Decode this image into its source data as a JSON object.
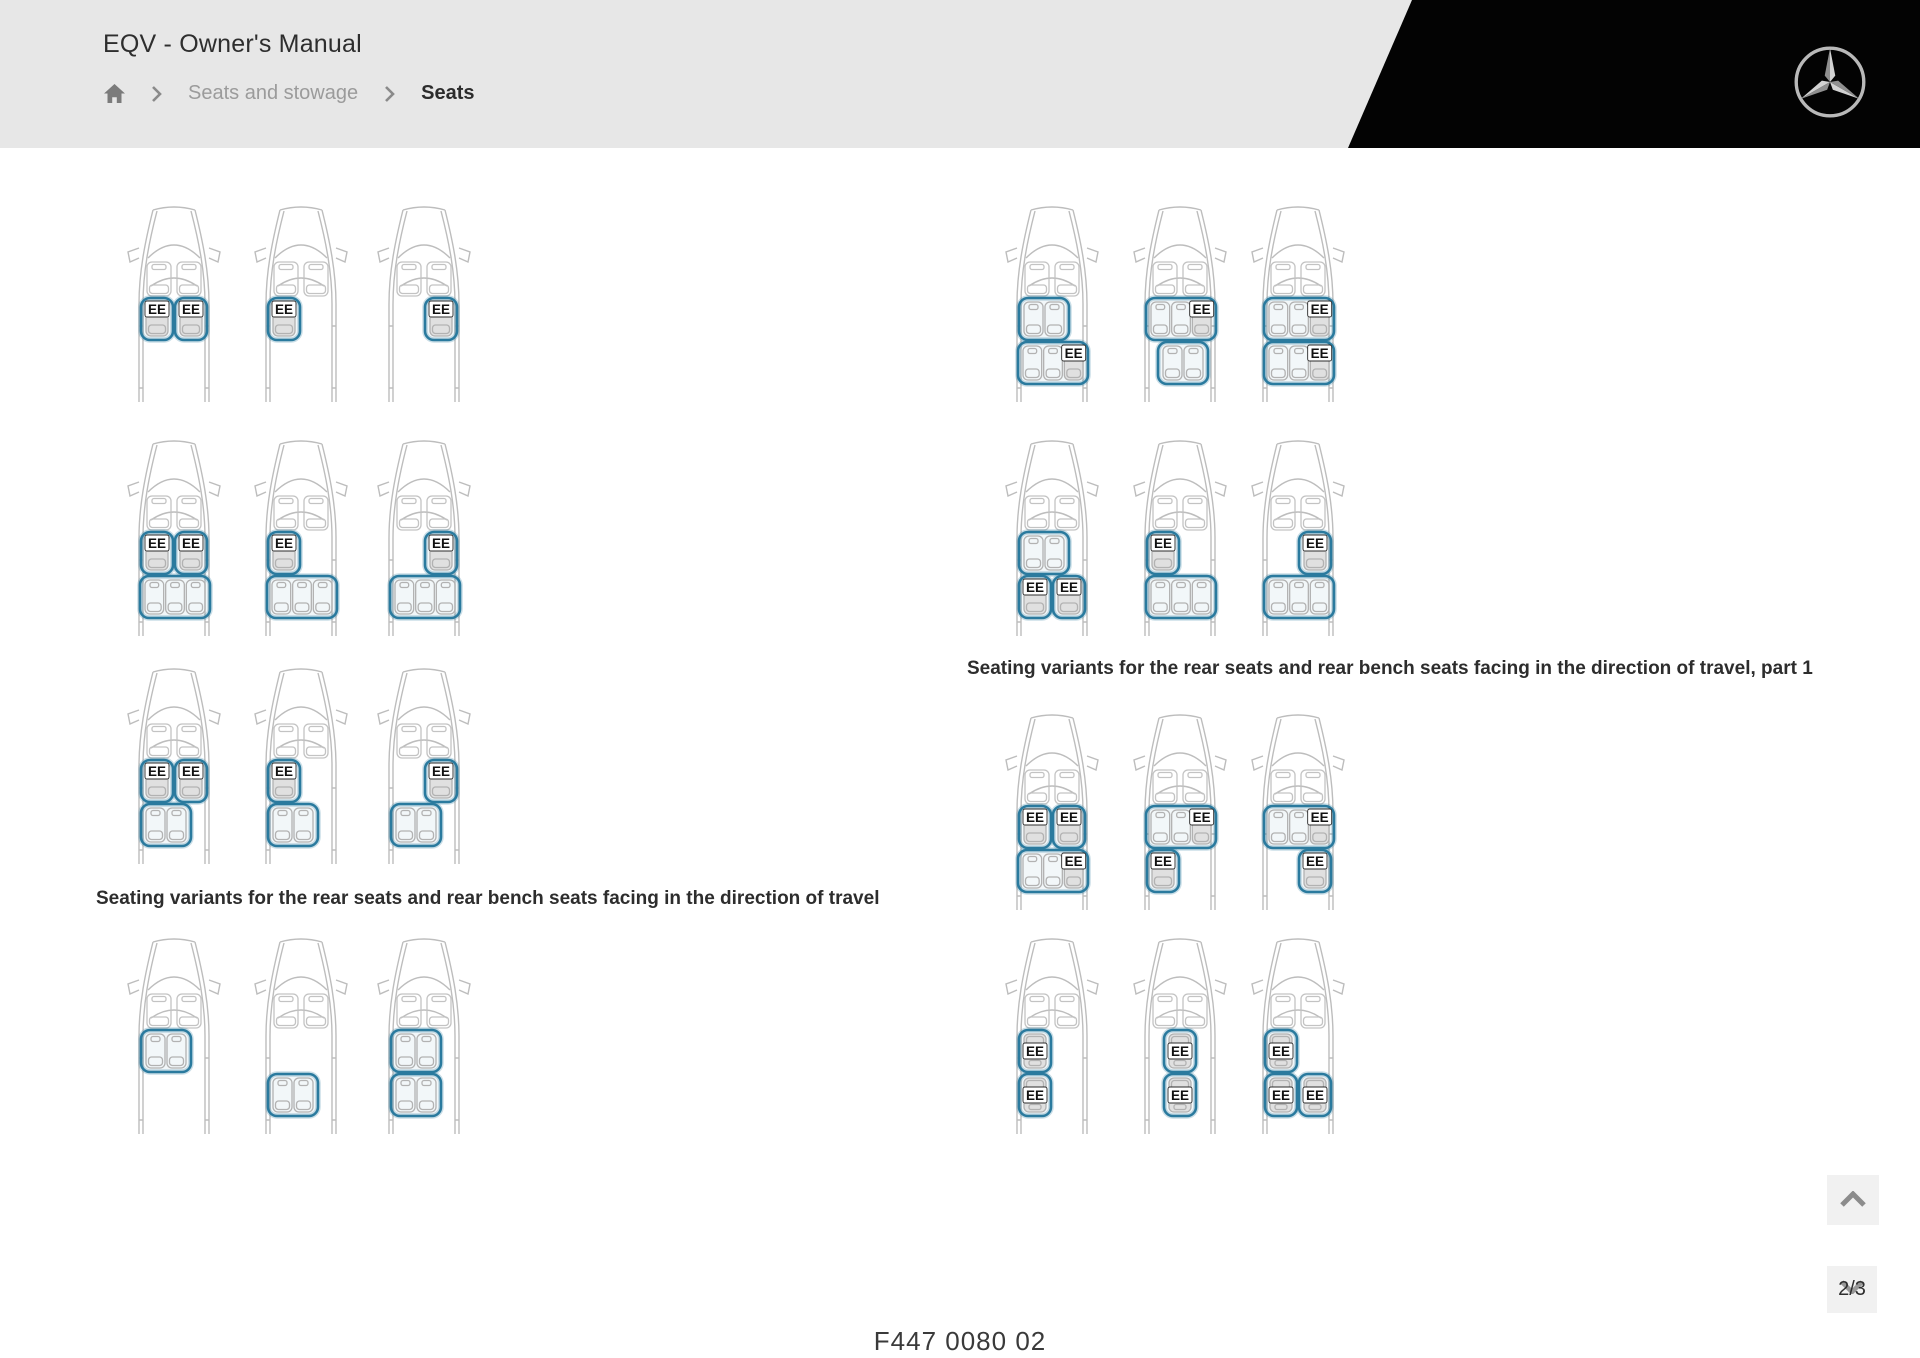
{
  "header": {
    "title": "EQV - Owner's Manual",
    "breadcrumb": {
      "items": [
        {
          "label": "Seats and stowage"
        },
        {
          "label": "Seats"
        }
      ]
    },
    "icons": {
      "home": "home-icon",
      "separator": "chevron-right-icon",
      "brand": "mercedes-star-icon"
    },
    "colors": {
      "background": "#e7e7e7",
      "wedge": "#030303"
    }
  },
  "figures": {
    "seat_label": "EE",
    "highlight_color": "#2a7a9e",
    "left_caption": "Seating variants for the rear seats and rear bench seats facing in the direction of travel",
    "right_caption": "Seating variants for the rear seats and rear bench seats facing in the direction of travel, part 1",
    "vans_left": [
      {
        "seats": [
          {
            "row": 2,
            "pos": "left",
            "kind": "single",
            "ee": true
          },
          {
            "row": 2,
            "pos": "right",
            "kind": "single",
            "ee": true
          }
        ]
      },
      {
        "seats": [
          {
            "row": 2,
            "pos": "left",
            "kind": "single",
            "ee": true
          }
        ]
      },
      {
        "seats": [
          {
            "row": 2,
            "pos": "right",
            "kind": "single",
            "ee": true
          }
        ]
      },
      {
        "seats": [
          {
            "row": 2,
            "pos": "left",
            "kind": "single",
            "ee": true
          },
          {
            "row": 2,
            "pos": "right",
            "kind": "single",
            "ee": true
          },
          {
            "row": 3,
            "pos": "left",
            "kind": "bench3",
            "ee": false
          }
        ]
      },
      {
        "seats": [
          {
            "row": 2,
            "pos": "left",
            "kind": "single",
            "ee": true
          },
          {
            "row": 3,
            "pos": "left",
            "kind": "bench3",
            "ee": false
          }
        ]
      },
      {
        "seats": [
          {
            "row": 2,
            "pos": "right",
            "kind": "single",
            "ee": true
          },
          {
            "row": 3,
            "pos": "left",
            "kind": "bench3",
            "ee": false
          }
        ]
      },
      {
        "seats": [
          {
            "row": 2,
            "pos": "left",
            "kind": "single",
            "ee": true
          },
          {
            "row": 2,
            "pos": "right",
            "kind": "single",
            "ee": true
          },
          {
            "row": 3,
            "pos": "left",
            "kind": "bench2",
            "ee": false
          }
        ]
      },
      {
        "seats": [
          {
            "row": 2,
            "pos": "left",
            "kind": "single",
            "ee": true
          },
          {
            "row": 3,
            "pos": "left",
            "kind": "bench2",
            "ee": false
          }
        ]
      },
      {
        "seats": [
          {
            "row": 2,
            "pos": "right",
            "kind": "single",
            "ee": true
          },
          {
            "row": 3,
            "pos": "left",
            "kind": "bench2",
            "ee": false
          }
        ]
      },
      {
        "seats": [
          {
            "row": 2,
            "pos": "left",
            "kind": "bench2",
            "ee": false
          }
        ]
      },
      {
        "seats": [
          {
            "row": 3,
            "pos": "left",
            "kind": "bench2",
            "ee": false
          }
        ]
      },
      {
        "seats": [
          {
            "row": 2,
            "pos": "left",
            "kind": "bench2",
            "ee": false
          },
          {
            "row": 3,
            "pos": "left",
            "kind": "bench2",
            "ee": false
          }
        ]
      }
    ],
    "vans_right": [
      {
        "seats": [
          {
            "row": 2,
            "pos": "left",
            "kind": "bench2",
            "ee": false
          },
          {
            "row": 3,
            "pos": "left",
            "kind": "bench3",
            "ee": true,
            "ee_seat": "right"
          }
        ]
      },
      {
        "seats": [
          {
            "row": 2,
            "pos": "left",
            "kind": "bench3",
            "ee": true,
            "ee_seat": "right"
          },
          {
            "row": 3,
            "pos": "center",
            "kind": "bench2",
            "ee": false
          }
        ]
      },
      {
        "seats": [
          {
            "row": 2,
            "pos": "left",
            "kind": "bench3",
            "ee": true,
            "ee_seat": "right"
          },
          {
            "row": 3,
            "pos": "left",
            "kind": "bench3",
            "ee": true,
            "ee_seat": "right"
          }
        ]
      },
      {
        "seats": [
          {
            "row": 2,
            "pos": "left",
            "kind": "bench2",
            "ee": false
          },
          {
            "row": 3,
            "pos": "left",
            "kind": "single",
            "ee": true
          },
          {
            "row": 3,
            "pos": "right",
            "kind": "single",
            "ee": true
          }
        ]
      },
      {
        "seats": [
          {
            "row": 2,
            "pos": "left",
            "kind": "single",
            "ee": true
          },
          {
            "row": 3,
            "pos": "left",
            "kind": "bench3",
            "ee": false
          }
        ]
      },
      {
        "seats": [
          {
            "row": 2,
            "pos": "right",
            "kind": "single",
            "ee": true
          },
          {
            "row": 3,
            "pos": "left",
            "kind": "bench3",
            "ee": false
          }
        ]
      },
      {
        "seats": [
          {
            "row": 2,
            "pos": "left",
            "kind": "single",
            "ee": true
          },
          {
            "row": 2,
            "pos": "right",
            "kind": "single",
            "ee": true
          },
          {
            "row": 3,
            "pos": "left",
            "kind": "bench3",
            "ee": true,
            "ee_seat": "right"
          }
        ]
      },
      {
        "seats": [
          {
            "row": 2,
            "pos": "left",
            "kind": "bench3",
            "ee": true,
            "ee_seat": "right"
          },
          {
            "row": 3,
            "pos": "left",
            "kind": "single",
            "ee": true
          }
        ]
      },
      {
        "seats": [
          {
            "row": 2,
            "pos": "left",
            "kind": "bench3",
            "ee": true,
            "ee_seat": "right"
          },
          {
            "row": 3,
            "pos": "right",
            "kind": "single",
            "ee": true
          }
        ]
      },
      {
        "seats": [
          {
            "row": 2,
            "pos": "left",
            "kind": "single",
            "ee": true,
            "rear": true
          },
          {
            "row": 3,
            "pos": "left",
            "kind": "single",
            "ee": true,
            "rear": true
          }
        ]
      },
      {
        "seats": [
          {
            "row": 2,
            "pos": "center",
            "kind": "single",
            "ee": true,
            "rear": true
          },
          {
            "row": 3,
            "pos": "center",
            "kind": "single",
            "ee": true,
            "rear": true
          }
        ]
      },
      {
        "seats": [
          {
            "row": 2,
            "pos": "left",
            "kind": "single",
            "ee": true,
            "rear": true
          },
          {
            "row": 3,
            "pos": "left",
            "kind": "single",
            "ee": true,
            "rear": true
          },
          {
            "row": 3,
            "pos": "right",
            "kind": "single",
            "ee": true,
            "rear": true
          }
        ]
      }
    ]
  },
  "footer": {
    "figure_code": "F447 0080 02",
    "page_indicator": "2/3",
    "icons": {
      "up": "chevron-up-icon",
      "down": "chevron-down-icon"
    }
  }
}
